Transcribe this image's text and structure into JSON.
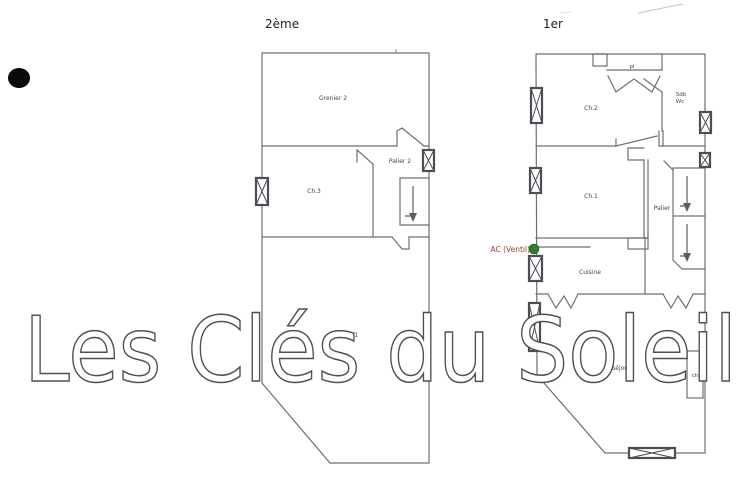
{
  "document_type": "floor-plan-scan",
  "watermark": {
    "text": "Les Clés du Soleil",
    "outline_color": "#4f4f55"
  },
  "plan_left": {
    "floor_label": "2ème",
    "rooms": {
      "grenier2": "Grenier 2",
      "ch3": "Ch.3",
      "palier2": "Palier 2",
      "grenier1": "Grenier 1"
    }
  },
  "plan_right": {
    "floor_label": "1er",
    "rooms": {
      "pl": "pl",
      "ch2": "Ch.2",
      "sdb": "Sdb",
      "wc": "Wc",
      "ch1": "Ch.1",
      "palier": "Palier",
      "cuisine": "Cuisine",
      "sejour": "Séjour",
      "ch": "ch"
    }
  },
  "annotations": {
    "ac_label": "AC (Ventil)",
    "ac_label_color": "#9c4038",
    "ac_marker_color": "#2e7b31"
  },
  "colors": {
    "background": "#ffffff",
    "plan_line": "#6e6e79",
    "window_symbol": "#4d4d55",
    "scan_dot": "#0a0a0a"
  }
}
